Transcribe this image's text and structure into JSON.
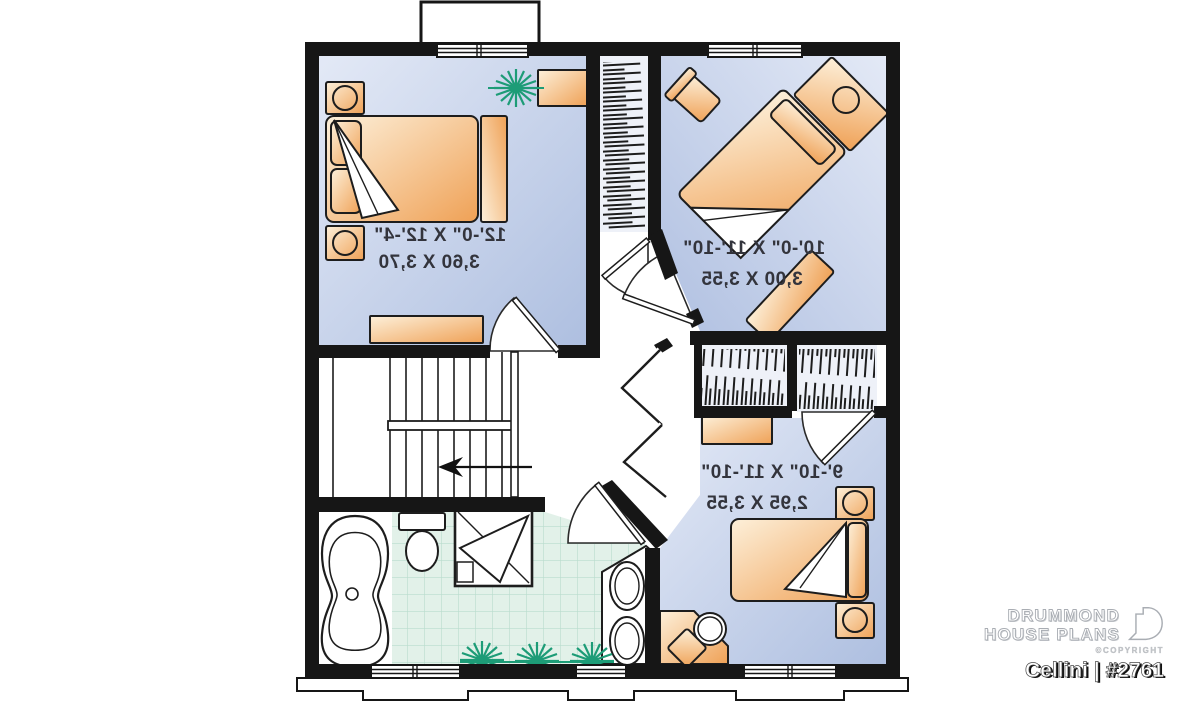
{
  "plan": {
    "rooms": [
      {
        "id": "bedroom-1",
        "imperial": "12'-0\" X 12'-4\"",
        "metric": "3,60 X 3,70"
      },
      {
        "id": "bedroom-2",
        "imperial": "10'-0\" X 11'-10\"",
        "metric": "3,00 X 3,55"
      },
      {
        "id": "bedroom-3",
        "imperial": "9'-10\" X 11'-10\"",
        "metric": "2,95 X 3,55"
      }
    ],
    "labels_mirrored": true,
    "icons": [
      "plant-icon",
      "stair-direction-arrow-icon",
      "drummond-logo-icon"
    ],
    "colors": {
      "wall": "#161616",
      "room_fill_light": "#dfe6f4",
      "room_fill_dark": "#aebfe0",
      "furniture_light": "#fdeed6",
      "furniture_dark": "#efa156",
      "tile": "#e2f1e9",
      "tile_grid": "#b9dccd",
      "plant_green": "#1d9c77",
      "closet_fill": "#eef1f8"
    }
  },
  "branding": {
    "line1": "DRUMMOND",
    "line2": "HOUSE PLANS",
    "copyright": "©COPYRIGHT",
    "plan_name": "Cellini",
    "separator": "|",
    "plan_number": "#2761"
  }
}
